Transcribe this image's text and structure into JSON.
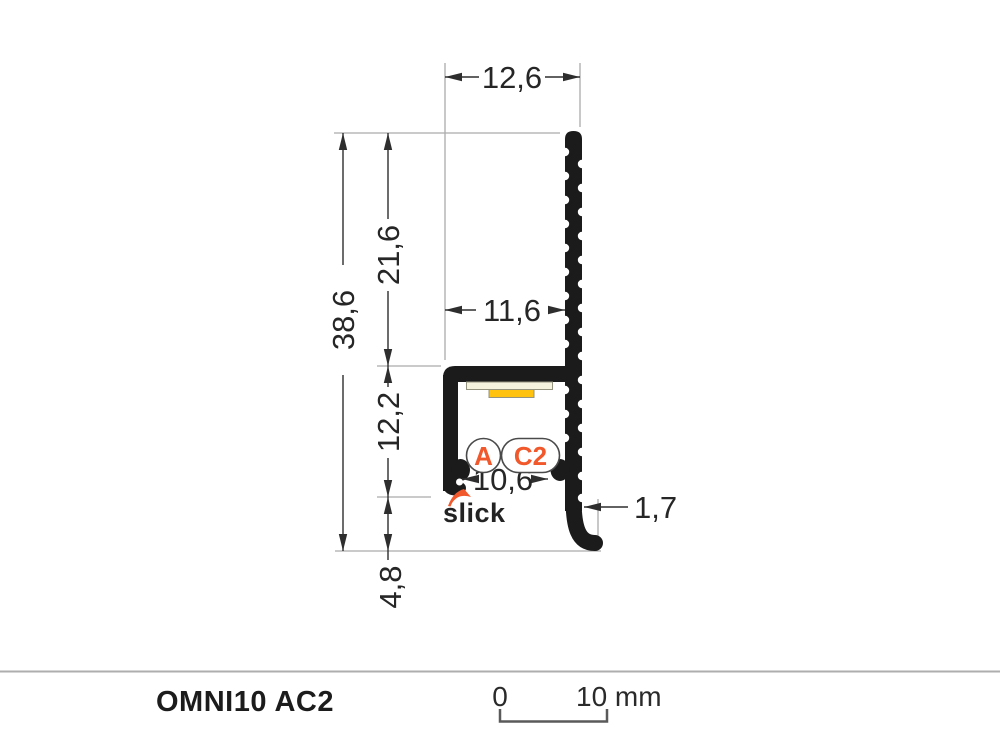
{
  "drawing": {
    "dimensions": {
      "overall_width": "12,6",
      "upper_fin_height": "21,6",
      "overall_height": "38,6",
      "body_width": "11,6",
      "channel_height": "12,2",
      "opening_width": "10,6",
      "wall_thickness": "1,7",
      "foot_height": "4,8"
    },
    "badges": {
      "variant_a": "A",
      "variant_c2": "C2"
    },
    "brand": "slick"
  },
  "footer": {
    "title": "OMNI10 AC2",
    "scale_bar": {
      "start_label": "0",
      "end_label": "10 mm"
    }
  },
  "colors": {
    "profile_black": "#1B1B1B",
    "accent_orange": "#F1582B",
    "led_yellow": "#FFC20E",
    "led_pcb_cream": "#F5F2DD",
    "dimension_line": "#2E2E2E",
    "extension_line": "#ABABAB"
  }
}
